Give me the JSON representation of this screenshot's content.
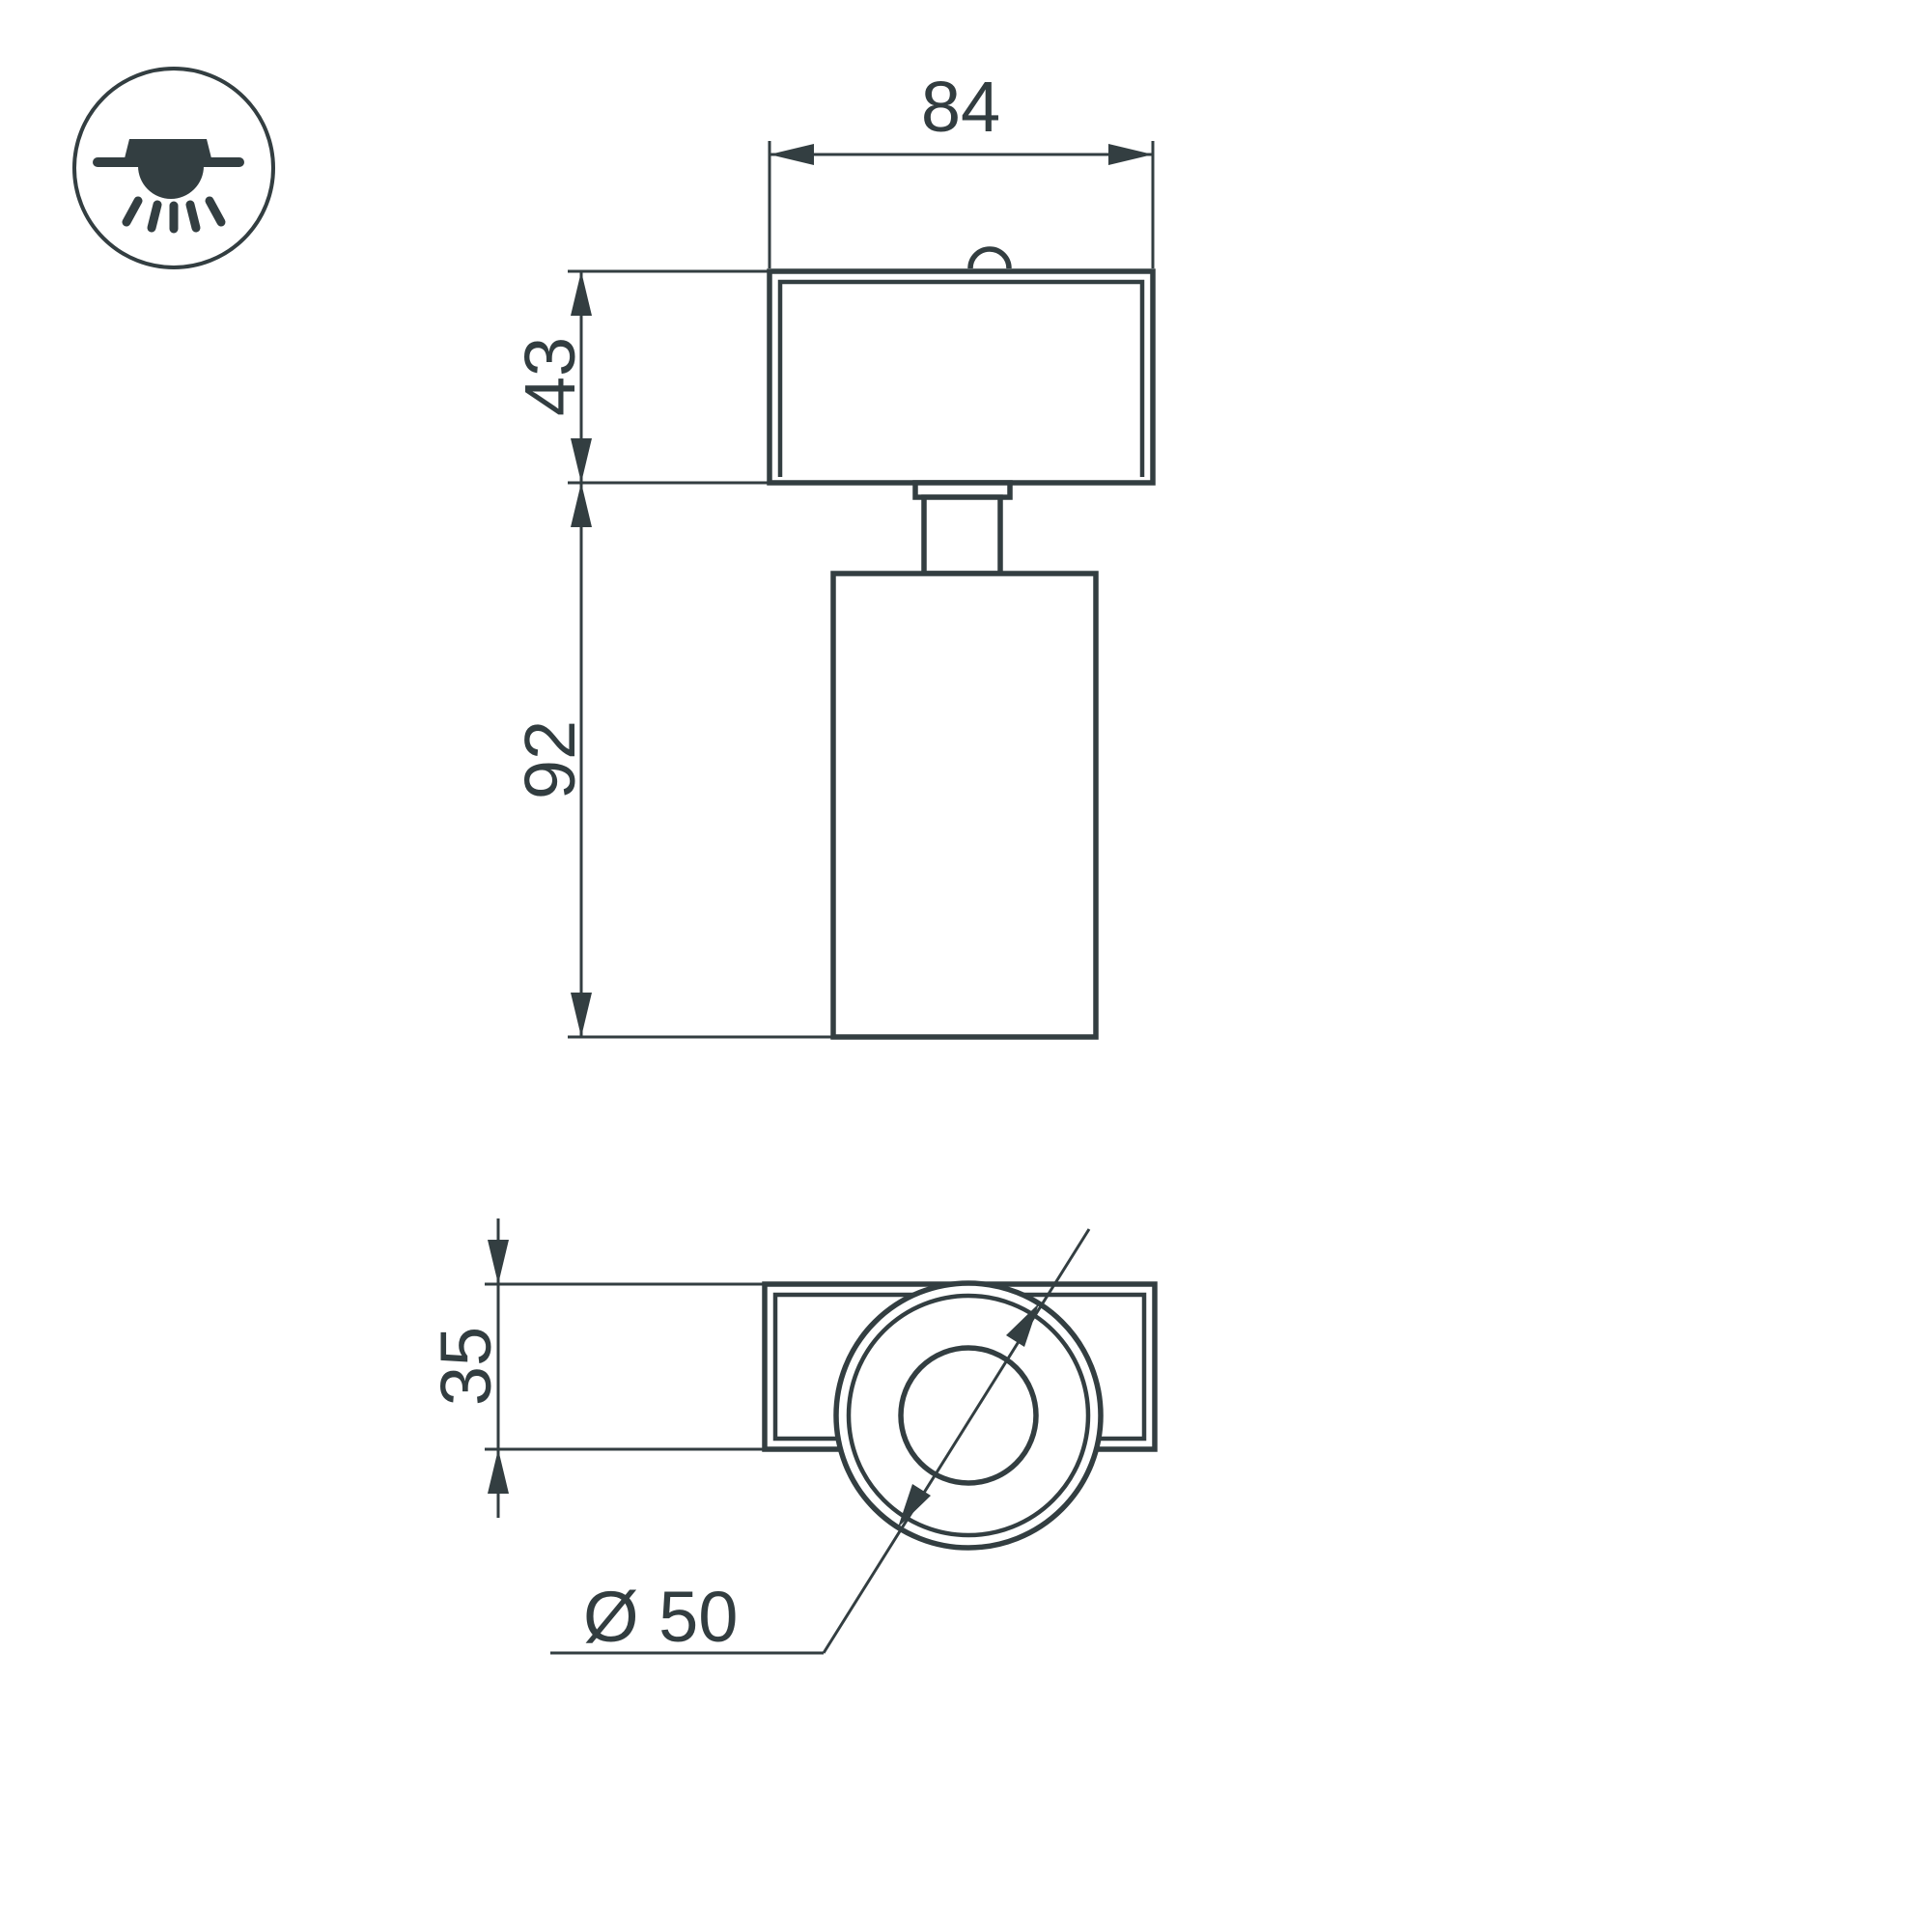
{
  "drawing": {
    "type": "dimension-drawing",
    "background": "#ffffff",
    "line_color": "#333e41",
    "text_color": "#323d40"
  },
  "icon": {
    "name": "surface-mounted-downlight-icon"
  },
  "front_view": {
    "width": "84",
    "housing_height": "43",
    "body_height": "92"
  },
  "plan_view": {
    "housing_depth": "35",
    "body_diameter": "Ø 50"
  }
}
